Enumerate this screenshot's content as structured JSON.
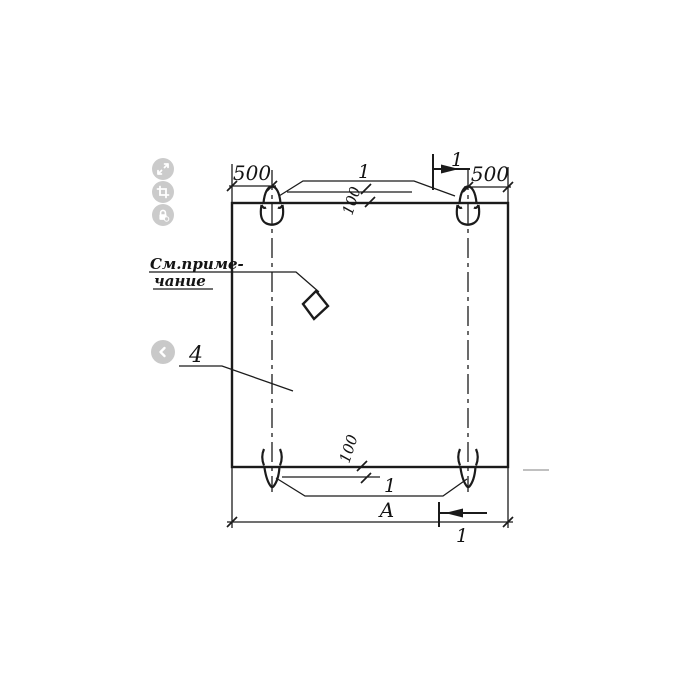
{
  "viewer": {
    "background": "#ffffff",
    "icon_bg": "#cbcbcb",
    "icon_fg": "#ffffff",
    "toolbar": {
      "buttons": [
        {
          "name": "fullscreen"
        },
        {
          "name": "crop"
        },
        {
          "name": "protect-lock"
        }
      ]
    },
    "nav": {
      "prev": "previous-image"
    }
  },
  "drawing": {
    "ink_color": "#1b1b1b",
    "note": {
      "line1": "См.приме-",
      "line2": "чание"
    },
    "labels": {
      "dim_left_500": "500",
      "dim_right_500": "500",
      "dim_top_100": "100",
      "dim_bottom_100": "100",
      "loop_callout_top": "1",
      "loop_callout_bottom": "1",
      "section_mark_top": "1",
      "section_mark_bottom": "1",
      "panel_callout": "4",
      "overall_width": "А"
    }
  }
}
